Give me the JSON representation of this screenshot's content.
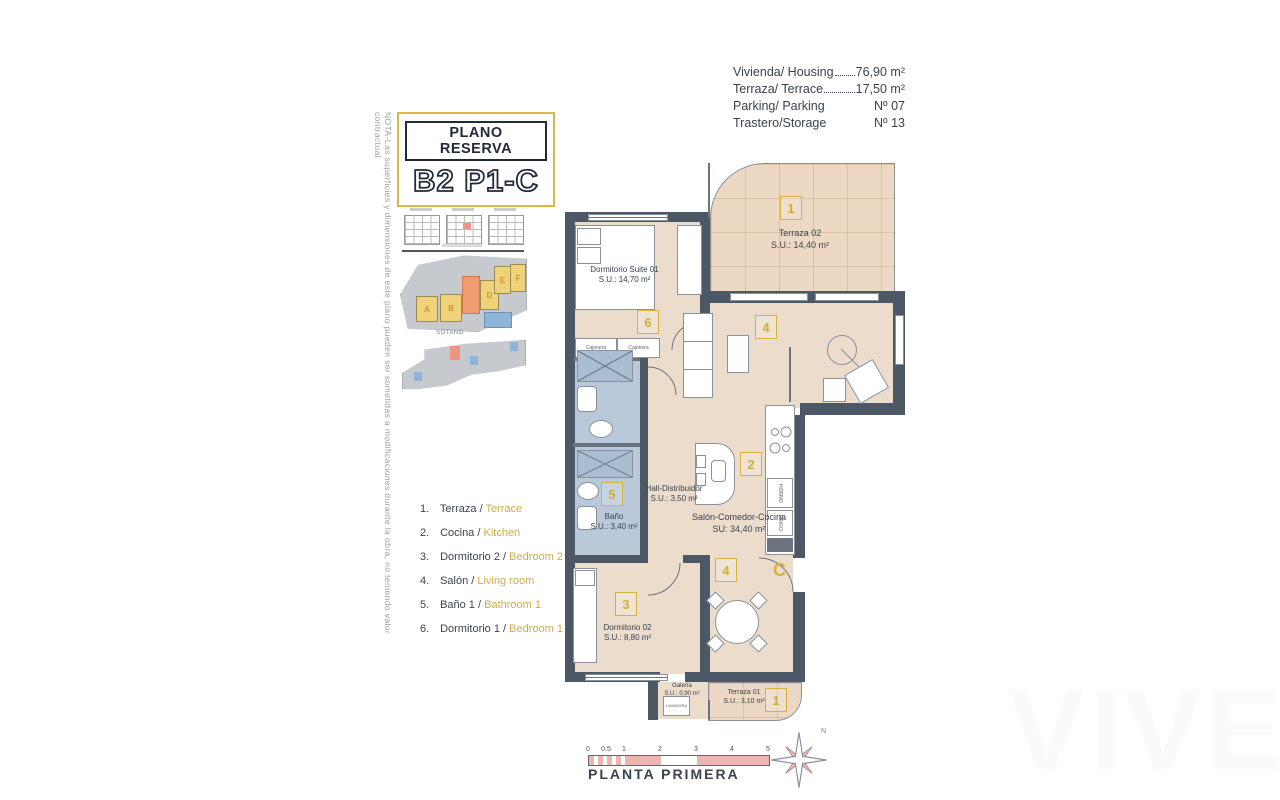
{
  "nota": "NOTA-Las superficies y dimensiones de este plano pueden ser sometidas a modificaciones durante la obra, no teniendo valor contractual",
  "title_box": {
    "line1": "PLANO RESERVA",
    "line2": "B2 P1-C"
  },
  "info": {
    "rows": [
      {
        "label": "Vivienda/ Housing",
        "value": "76,90 m²",
        "leader": true
      },
      {
        "label": "Terraza/ Terrace",
        "value": "17,50 m²",
        "leader": true
      },
      {
        "label": "Parking/ Parking",
        "value": "Nº 07",
        "leader": false
      },
      {
        "label": "Trastero/Storage",
        "value": "Nº 13",
        "leader": false
      }
    ]
  },
  "minimap": {
    "sotano": "SÓTANO",
    "blocks": [
      "A",
      "B",
      "D",
      "E",
      "F"
    ]
  },
  "legend": {
    "items": [
      {
        "num": "1.",
        "es": "Terraza /",
        "en": "Terrace"
      },
      {
        "num": "2.",
        "es": "Cocina /",
        "en": "Kitchen"
      },
      {
        "num": "3.",
        "es": "Dormitorio 2 /",
        "en": "Bedroom 2"
      },
      {
        "num": "4.",
        "es": "Salón /",
        "en": "Living room"
      },
      {
        "num": "5.",
        "es": "Baño 1 /",
        "en": "Bathroom 1"
      },
      {
        "num": "6.",
        "es": "Dormitorio 1 /",
        "en": "Bedroom 1"
      }
    ]
  },
  "plan": {
    "rooms": {
      "terraza02": {
        "name": "Terraza 02",
        "area": "S.U.: 14,40 m²",
        "marker": "1"
      },
      "suite": {
        "name": "Dormitorio Suite 01",
        "area": "S.U.: 14,70 m²",
        "marker": "6"
      },
      "hall": {
        "name": "Hall-Distribuidor",
        "area": "S.U.: 3,50 m²"
      },
      "bano": {
        "name": "Baño",
        "area": "S.U.: 3,40 m²",
        "marker": "5"
      },
      "salon": {
        "name": "Salón-Comedor-Cocina",
        "area": "SU: 34,40 m²",
        "marker_living": "4",
        "marker_kitchen": "2",
        "marker_dining": "4"
      },
      "dorm02": {
        "name": "Dormitorio 02",
        "area": "S.U.: 8,80 m²",
        "marker": "3"
      },
      "galeria": {
        "name": "Galería",
        "area": "S.U.: 0,90 m²",
        "appliance": "LAVADORA"
      },
      "terraza01": {
        "name": "Terraza 01",
        "area": "S.U.: 3,10 m²",
        "marker": "1"
      }
    },
    "entrance_letter": "C",
    "closet_labels": [
      "Cajonera",
      "Cajonera"
    ],
    "kitchen_labels": [
      "HORNO",
      "FRIGO"
    ]
  },
  "footer": {
    "scale_ticks": [
      "0",
      "0.5",
      "1",
      "2",
      "3",
      "4",
      "5"
    ],
    "floor_label": "PLANTA PRIMERA",
    "compass_n": "N"
  },
  "watermark": "VIVE",
  "colors": {
    "accent": "#d7b23e",
    "wall": "#4d5866",
    "floor": "#ecdccb",
    "bath": "#b9c9da",
    "highlight": "#ef9382",
    "scale_pink": "#eab6b0"
  }
}
